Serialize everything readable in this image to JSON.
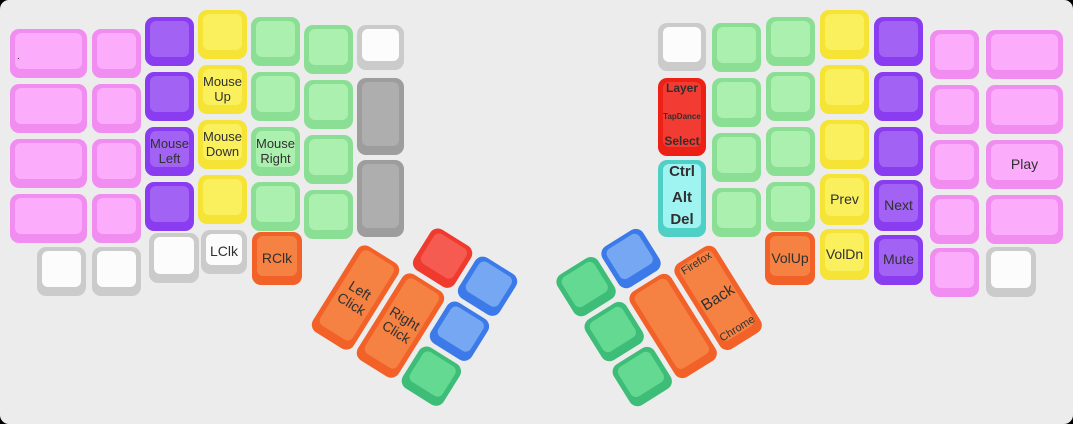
{
  "app": {
    "background": "#edecec",
    "frame_color": "#000000",
    "description_labels": {
      "left_half": "left keyboard half",
      "right_half": "right keyboard half"
    }
  },
  "palette": {
    "pink": {
      "border": "#F18CF1",
      "fill": "#FBACFB"
    },
    "purple": {
      "border": "#8A3DF0",
      "fill": "#A263F4"
    },
    "yellow": {
      "border": "#F5E336",
      "fill": "#FAEF5D"
    },
    "green": {
      "border": "#8ADF94",
      "fill": "#ACF0B0"
    },
    "white": {
      "border": "#CBCBCB",
      "fill": "#FCFCFC"
    },
    "gray": {
      "border": "#9D9D9D",
      "fill": "#AEAEAE"
    },
    "orange": {
      "border": "#F26127",
      "fill": "#F58142"
    },
    "red": {
      "border": "#EC2015",
      "fill": "#F23C33"
    },
    "redThumb": {
      "border": "#F03A2E",
      "fill": "#F55B50"
    },
    "cyan": {
      "border": "#4FD0C6",
      "fill": "#9FF3F0"
    },
    "blue": {
      "border": "#3B7AE8",
      "fill": "#75A7F2"
    },
    "greenThumb": {
      "border": "#3DBD77",
      "fill": "#63D992"
    }
  },
  "keys": [
    {
      "id": "left-c1-r1",
      "x": 10,
      "y": 29,
      "w": 77,
      "h": 49,
      "color": "pink",
      "labels": [
        {
          "text": ".",
          "pos": "left",
          "size": 10
        }
      ]
    },
    {
      "id": "left-c1-r2",
      "x": 10,
      "y": 84,
      "w": 77,
      "h": 49,
      "color": "pink"
    },
    {
      "id": "left-c1-r3",
      "x": 10,
      "y": 139,
      "w": 77,
      "h": 49,
      "color": "pink"
    },
    {
      "id": "left-c1-r4",
      "x": 10,
      "y": 194,
      "w": 77,
      "h": 49,
      "color": "pink"
    },
    {
      "id": "left-c1-bottom",
      "x": 37,
      "y": 247,
      "w": 49,
      "h": 49,
      "color": "white"
    },
    {
      "id": "left-c2-r1",
      "x": 92,
      "y": 29,
      "w": 49,
      "h": 49,
      "color": "pink"
    },
    {
      "id": "left-c2-r2",
      "x": 92,
      "y": 84,
      "w": 49,
      "h": 49,
      "color": "pink"
    },
    {
      "id": "left-c2-r3",
      "x": 92,
      "y": 139,
      "w": 49,
      "h": 49,
      "color": "pink"
    },
    {
      "id": "left-c2-r4",
      "x": 92,
      "y": 194,
      "w": 49,
      "h": 49,
      "color": "pink"
    },
    {
      "id": "left-c2-bottom",
      "x": 92,
      "y": 247,
      "w": 49,
      "h": 49,
      "color": "white"
    },
    {
      "id": "left-c3-r1",
      "x": 145,
      "y": 17,
      "w": 49,
      "h": 49,
      "color": "purple"
    },
    {
      "id": "left-c3-r2",
      "x": 145,
      "y": 72,
      "w": 49,
      "h": 49,
      "color": "purple"
    },
    {
      "id": "left-c3-r3",
      "x": 145,
      "y": 127,
      "w": 49,
      "h": 49,
      "color": "purple",
      "labels": [
        {
          "text": "Mouse\nLeft",
          "pos": "center",
          "size": 13
        }
      ]
    },
    {
      "id": "left-c3-r4",
      "x": 145,
      "y": 182,
      "w": 49,
      "h": 49,
      "color": "purple"
    },
    {
      "id": "left-c3-bottom",
      "x": 149,
      "y": 233,
      "w": 50,
      "h": 50,
      "color": "white"
    },
    {
      "id": "left-c4-r1",
      "x": 198,
      "y": 10,
      "w": 49,
      "h": 49,
      "color": "yellow"
    },
    {
      "id": "left-c4-r2",
      "x": 198,
      "y": 65,
      "w": 49,
      "h": 49,
      "color": "yellow",
      "labels": [
        {
          "text": "Mouse\nUp",
          "pos": "center",
          "size": 13
        }
      ]
    },
    {
      "id": "left-c4-r3",
      "x": 198,
      "y": 120,
      "w": 49,
      "h": 49,
      "color": "yellow",
      "labels": [
        {
          "text": "Mouse\nDown",
          "pos": "center",
          "size": 13
        }
      ]
    },
    {
      "id": "left-c4-r4",
      "x": 198,
      "y": 175,
      "w": 49,
      "h": 49,
      "color": "yellow"
    },
    {
      "id": "left-lclk",
      "x": 201,
      "y": 230,
      "w": 46,
      "h": 44,
      "color": "white",
      "labels": [
        {
          "text": "LClk",
          "pos": "center",
          "size": 14
        }
      ]
    },
    {
      "id": "left-c5-r1",
      "x": 251,
      "y": 17,
      "w": 49,
      "h": 49,
      "color": "green"
    },
    {
      "id": "left-c5-r2",
      "x": 251,
      "y": 72,
      "w": 49,
      "h": 49,
      "color": "green"
    },
    {
      "id": "left-c5-r3",
      "x": 251,
      "y": 127,
      "w": 49,
      "h": 49,
      "color": "green",
      "labels": [
        {
          "text": "Mouse\nRight",
          "pos": "center",
          "size": 13
        }
      ]
    },
    {
      "id": "left-c5-r4",
      "x": 251,
      "y": 182,
      "w": 49,
      "h": 49,
      "color": "green"
    },
    {
      "id": "left-rclk",
      "x": 252,
      "y": 232,
      "w": 50,
      "h": 53,
      "color": "orange",
      "labels": [
        {
          "text": "RClk",
          "pos": "center",
          "size": 14
        }
      ]
    },
    {
      "id": "left-c6-r1",
      "x": 304,
      "y": 25,
      "w": 49,
      "h": 49,
      "color": "green"
    },
    {
      "id": "left-c6-r2",
      "x": 304,
      "y": 80,
      "w": 49,
      "h": 49,
      "color": "green"
    },
    {
      "id": "left-c6-r3",
      "x": 304,
      "y": 135,
      "w": 49,
      "h": 49,
      "color": "green"
    },
    {
      "id": "left-c6-r4",
      "x": 304,
      "y": 190,
      "w": 49,
      "h": 49,
      "color": "green"
    },
    {
      "id": "left-c7-r1",
      "x": 357,
      "y": 25,
      "w": 47,
      "h": 45,
      "color": "white"
    },
    {
      "id": "left-c7-tall1",
      "x": 357,
      "y": 78,
      "w": 47,
      "h": 77,
      "color": "gray"
    },
    {
      "id": "left-c7-tall2",
      "x": 357,
      "y": 160,
      "w": 47,
      "h": 77,
      "color": "gray"
    },
    {
      "id": "right-c7-r1",
      "x": 658,
      "y": 23,
      "w": 48,
      "h": 48,
      "color": "white"
    },
    {
      "id": "right-layer-select",
      "x": 658,
      "y": 78,
      "w": 48,
      "h": 78,
      "color": "red",
      "labels": [
        {
          "text": "Layer",
          "pos": "top",
          "size": 12,
          "weight": 600
        },
        {
          "text": "TapDance",
          "pos": "center",
          "size": 8,
          "weight": 700
        },
        {
          "text": "Select",
          "pos": "bottom",
          "size": 12,
          "weight": 600
        }
      ]
    },
    {
      "id": "right-ctrl-alt-del",
      "x": 658,
      "y": 160,
      "w": 48,
      "h": 77,
      "color": "cyan",
      "labels": [
        {
          "text": "Ctrl",
          "pos": "top",
          "size": 15,
          "weight": 700
        },
        {
          "text": "Alt",
          "pos": "center",
          "size": 15,
          "weight": 700
        },
        {
          "text": "Del",
          "pos": "bottom",
          "size": 15,
          "weight": 700
        }
      ]
    },
    {
      "id": "right-c6-r1",
      "x": 712,
      "y": 23,
      "w": 49,
      "h": 49,
      "color": "green"
    },
    {
      "id": "right-c6-r2",
      "x": 712,
      "y": 78,
      "w": 49,
      "h": 49,
      "color": "green"
    },
    {
      "id": "right-c6-r3",
      "x": 712,
      "y": 133,
      "w": 49,
      "h": 49,
      "color": "green"
    },
    {
      "id": "right-c6-r4",
      "x": 712,
      "y": 188,
      "w": 49,
      "h": 49,
      "color": "green"
    },
    {
      "id": "right-c5-r1",
      "x": 766,
      "y": 17,
      "w": 49,
      "h": 49,
      "color": "green"
    },
    {
      "id": "right-c5-r2",
      "x": 766,
      "y": 72,
      "w": 49,
      "h": 49,
      "color": "green"
    },
    {
      "id": "right-c5-r3",
      "x": 766,
      "y": 127,
      "w": 49,
      "h": 49,
      "color": "green"
    },
    {
      "id": "right-c5-r4",
      "x": 766,
      "y": 182,
      "w": 49,
      "h": 49,
      "color": "green"
    },
    {
      "id": "right-volup",
      "x": 765,
      "y": 232,
      "w": 50,
      "h": 53,
      "color": "orange",
      "labels": [
        {
          "text": "VolUp",
          "pos": "center",
          "size": 14
        }
      ]
    },
    {
      "id": "right-c4-r1",
      "x": 820,
      "y": 10,
      "w": 49,
      "h": 49,
      "color": "yellow"
    },
    {
      "id": "right-c4-r2",
      "x": 820,
      "y": 65,
      "w": 49,
      "h": 49,
      "color": "yellow"
    },
    {
      "id": "right-c4-r3",
      "x": 820,
      "y": 120,
      "w": 49,
      "h": 49,
      "color": "yellow"
    },
    {
      "id": "right-prev",
      "x": 820,
      "y": 174,
      "w": 49,
      "h": 51,
      "color": "yellow",
      "labels": [
        {
          "text": "Prev",
          "pos": "center",
          "size": 14
        }
      ]
    },
    {
      "id": "right-voldn",
      "x": 820,
      "y": 229,
      "w": 49,
      "h": 51,
      "color": "yellow",
      "labels": [
        {
          "text": "VolDn",
          "pos": "center",
          "size": 14
        }
      ]
    },
    {
      "id": "right-c3-r1",
      "x": 874,
      "y": 17,
      "w": 49,
      "h": 49,
      "color": "purple"
    },
    {
      "id": "right-c3-r2",
      "x": 874,
      "y": 72,
      "w": 49,
      "h": 49,
      "color": "purple"
    },
    {
      "id": "right-c3-r3",
      "x": 874,
      "y": 127,
      "w": 49,
      "h": 49,
      "color": "purple"
    },
    {
      "id": "right-next",
      "x": 874,
      "y": 180,
      "w": 49,
      "h": 51,
      "color": "purple",
      "labels": [
        {
          "text": "Next",
          "pos": "center",
          "size": 14
        }
      ]
    },
    {
      "id": "right-mute",
      "x": 874,
      "y": 235,
      "w": 49,
      "h": 50,
      "color": "purple",
      "labels": [
        {
          "text": "Mute",
          "pos": "center",
          "size": 14
        }
      ]
    },
    {
      "id": "right-c2-r1",
      "x": 930,
      "y": 30,
      "w": 49,
      "h": 49,
      "color": "pink"
    },
    {
      "id": "right-c2-r2",
      "x": 930,
      "y": 85,
      "w": 49,
      "h": 49,
      "color": "pink"
    },
    {
      "id": "right-c2-r3",
      "x": 930,
      "y": 140,
      "w": 49,
      "h": 49,
      "color": "pink"
    },
    {
      "id": "right-c2-r4",
      "x": 930,
      "y": 195,
      "w": 49,
      "h": 49,
      "color": "pink"
    },
    {
      "id": "right-c2-r5",
      "x": 930,
      "y": 248,
      "w": 49,
      "h": 49,
      "color": "pink"
    },
    {
      "id": "right-c1-r1",
      "x": 986,
      "y": 30,
      "w": 77,
      "h": 49,
      "color": "pink"
    },
    {
      "id": "right-c1-r2",
      "x": 986,
      "y": 85,
      "w": 77,
      "h": 49,
      "color": "pink"
    },
    {
      "id": "right-play",
      "x": 986,
      "y": 140,
      "w": 77,
      "h": 49,
      "color": "pink",
      "labels": [
        {
          "text": "Play",
          "pos": "center",
          "size": 14
        }
      ]
    },
    {
      "id": "right-c1-r4",
      "x": 986,
      "y": 195,
      "w": 77,
      "h": 49,
      "color": "pink"
    },
    {
      "id": "right-c1-bottom",
      "x": 986,
      "y": 247,
      "w": 50,
      "h": 50,
      "color": "white"
    }
  ],
  "clusters": [
    {
      "id": "left-thumb-cluster",
      "x": 390,
      "y": 197,
      "angle": 32,
      "keys": [
        {
          "id": "lthumb-red",
          "x": 53,
          "y": 0,
          "w": 48,
          "h": 48,
          "color": "redThumb"
        },
        {
          "id": "lthumb-blue-top",
          "x": 106,
          "y": 0,
          "w": 48,
          "h": 48,
          "color": "blue"
        },
        {
          "id": "lthumb-left-click",
          "x": 0,
          "y": 53,
          "w": 48,
          "h": 101,
          "color": "orange",
          "labels": [
            {
              "text": "Left\nClick",
              "pos": "center",
              "size": 14
            }
          ]
        },
        {
          "id": "lthumb-right-click",
          "x": 53,
          "y": 53,
          "w": 48,
          "h": 101,
          "color": "orange",
          "labels": [
            {
              "text": "Right\nClick",
              "pos": "center",
              "size": 14
            }
          ]
        },
        {
          "id": "lthumb-blue-mid",
          "x": 106,
          "y": 53,
          "w": 48,
          "h": 48,
          "color": "blue"
        },
        {
          "id": "lthumb-green",
          "x": 106,
          "y": 106,
          "w": 48,
          "h": 48,
          "color": "greenThumb"
        }
      ]
    },
    {
      "id": "right-thumb-cluster",
      "x": 553,
      "y": 279,
      "angle": -32,
      "keys": [
        {
          "id": "rthumb-green-top",
          "x": 0,
          "y": 0,
          "w": 48,
          "h": 48,
          "color": "greenThumb"
        },
        {
          "id": "rthumb-blue",
          "x": 53,
          "y": 0,
          "w": 48,
          "h": 48,
          "color": "blue"
        },
        {
          "id": "rthumb-green-mid",
          "x": 0,
          "y": 53,
          "w": 48,
          "h": 48,
          "color": "greenThumb"
        },
        {
          "id": "rthumb-tall-blank",
          "x": 53,
          "y": 53,
          "w": 48,
          "h": 101,
          "color": "orange"
        },
        {
          "id": "rthumb-back",
          "x": 106,
          "y": 53,
          "w": 48,
          "h": 101,
          "color": "orange",
          "labels": [
            {
              "text": "Firefox",
              "pos": "top",
              "size": 11
            },
            {
              "text": "Back",
              "pos": "center",
              "size": 16
            },
            {
              "text": "Chrome",
              "pos": "bottom",
              "size": 11
            }
          ]
        },
        {
          "id": "rthumb-green-bot",
          "x": 0,
          "y": 106,
          "w": 48,
          "h": 48,
          "color": "greenThumb"
        }
      ]
    }
  ]
}
